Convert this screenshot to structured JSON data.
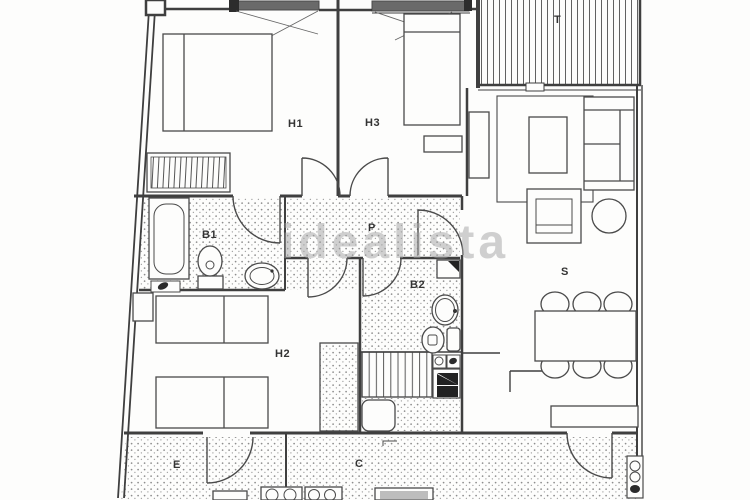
{
  "document": {
    "type_label": "floor-plan"
  },
  "watermark": {
    "text": "idealista",
    "color": "#a3a3a3"
  },
  "rooms": {
    "h1": {
      "label": "H1"
    },
    "h2": {
      "label": "H2"
    },
    "h3": {
      "label": "H3"
    },
    "b1": {
      "label": "B1"
    },
    "b2": {
      "label": "B2"
    },
    "p": {
      "label": "P"
    },
    "s": {
      "label": "S"
    },
    "e": {
      "label": "E"
    },
    "c": {
      "label": "C"
    },
    "t": {
      "label": "T"
    }
  },
  "colors": {
    "background": "#fdfdfc",
    "wall_line": "#3f3f3f",
    "furniture_line": "#4a4a4a",
    "floor_dot": "#8d8d8d",
    "dark_fill": "#262626",
    "watermark": "#a3a3a3"
  }
}
